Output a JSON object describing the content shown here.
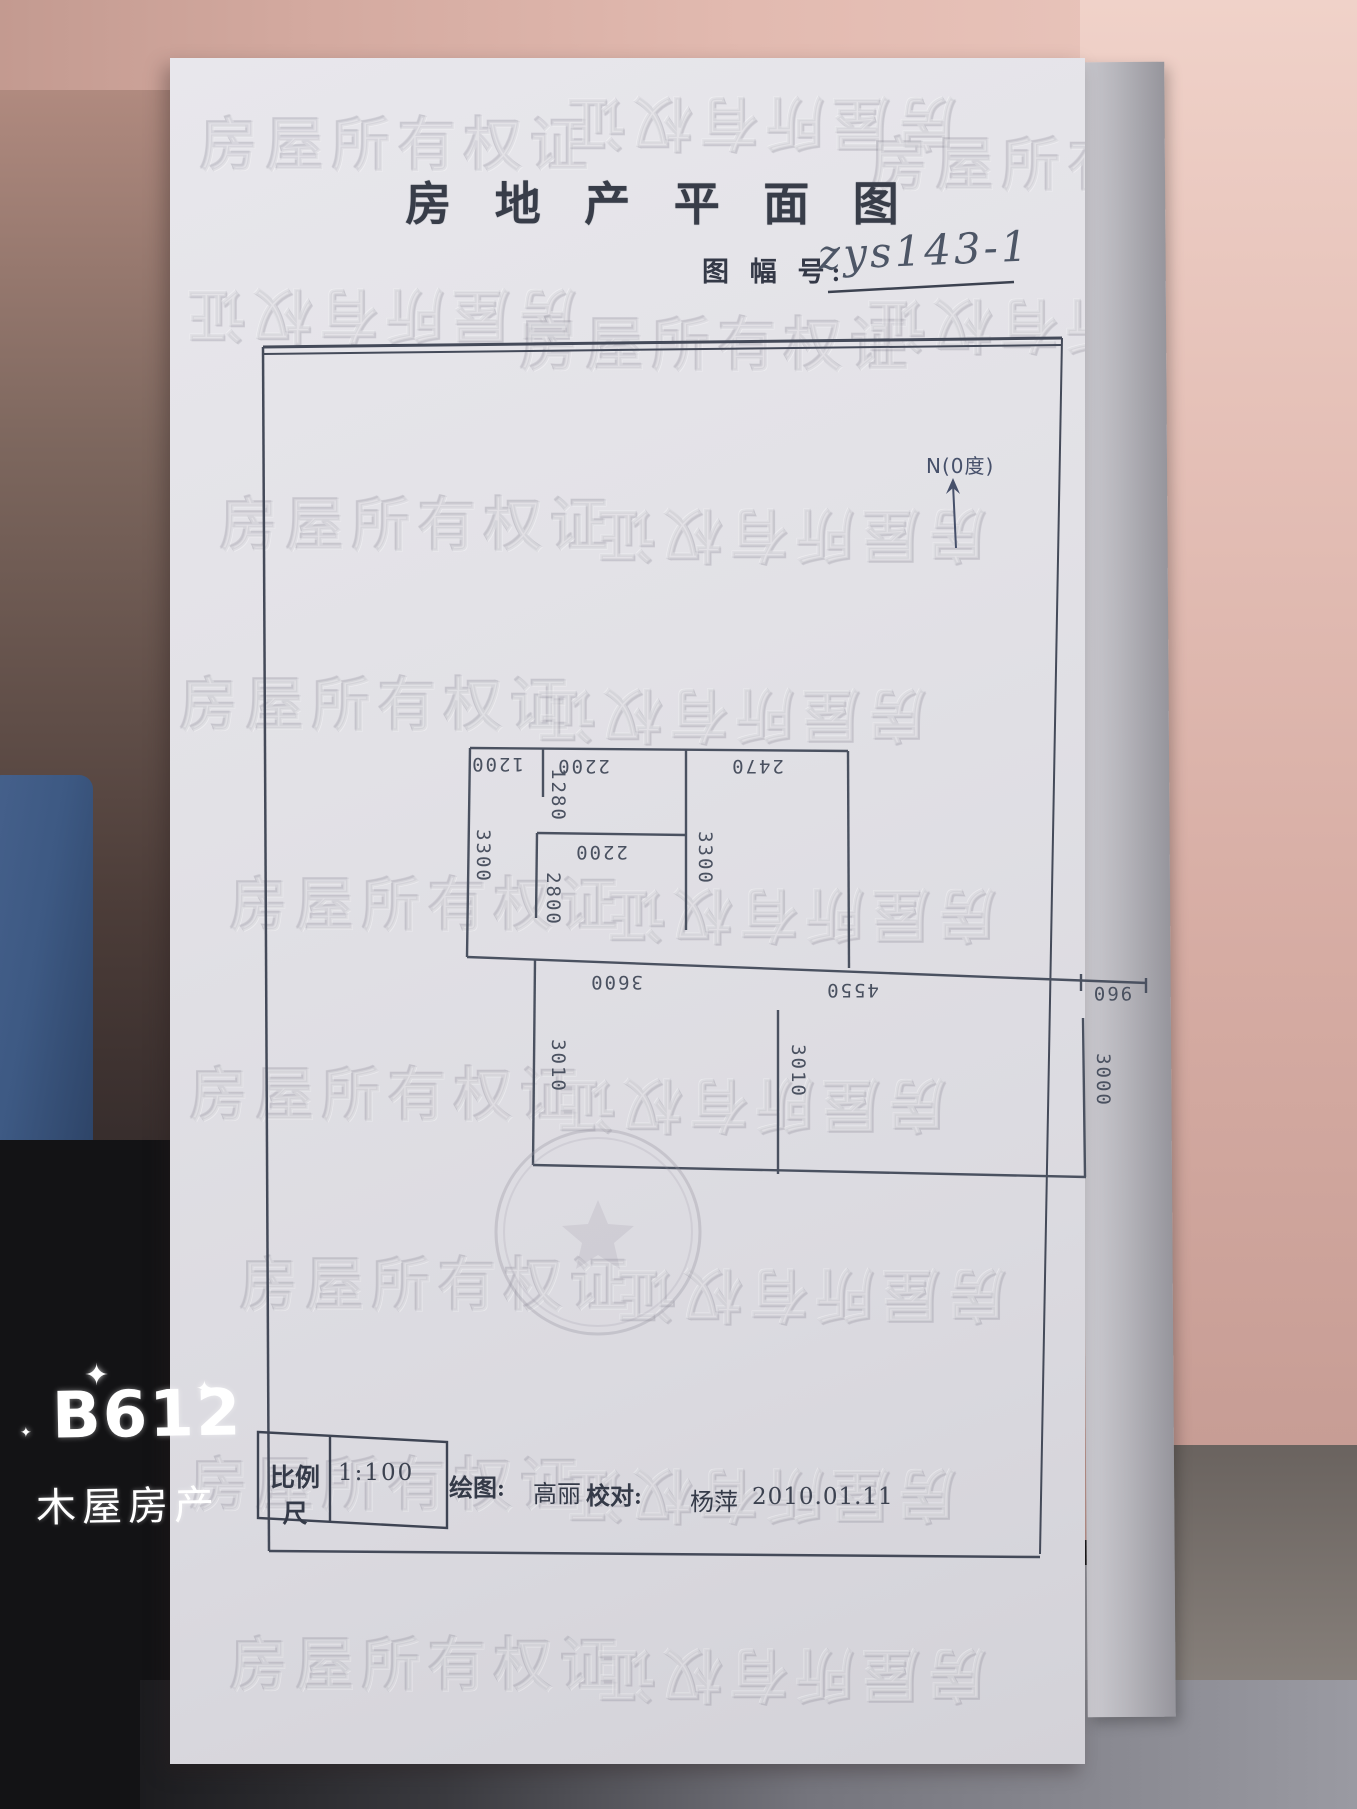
{
  "photo": {
    "camera_app": "B612",
    "brand_caption": "木屋房产"
  },
  "document": {
    "title": "房 地 产 平 面 图",
    "sheet_no_label": "图 幅 号:",
    "sheet_no_value": "zys143-1",
    "north_label": "N(0度)",
    "watermark_text": "房屋所有权证",
    "plan": {
      "dims": {
        "top_w1": "1200",
        "top_w2": "2200",
        "top_w3": "2470",
        "nook_h": "1280",
        "left_h": "3300",
        "mid_h": "3300",
        "inner_w": "2200",
        "inner_h": "2800",
        "low_w1": "3600",
        "low_w2": "4550",
        "low_w3": "960",
        "low_h1": "3010",
        "low_h2": "3010",
        "low_h3": "3000"
      }
    },
    "titleblock": {
      "scale_label": "比例尺",
      "scale_value": "1:100",
      "drawn_label": "绘图:",
      "drawn_name": "高丽",
      "check_label": "校对:",
      "check_name": "杨萍",
      "date": "2010.01.11"
    }
  },
  "colors": {
    "ink": "#4a5160",
    "paper": "#e2e1e6",
    "wall_pink": "#ddb3aa",
    "blue_object": "#3d5983"
  }
}
